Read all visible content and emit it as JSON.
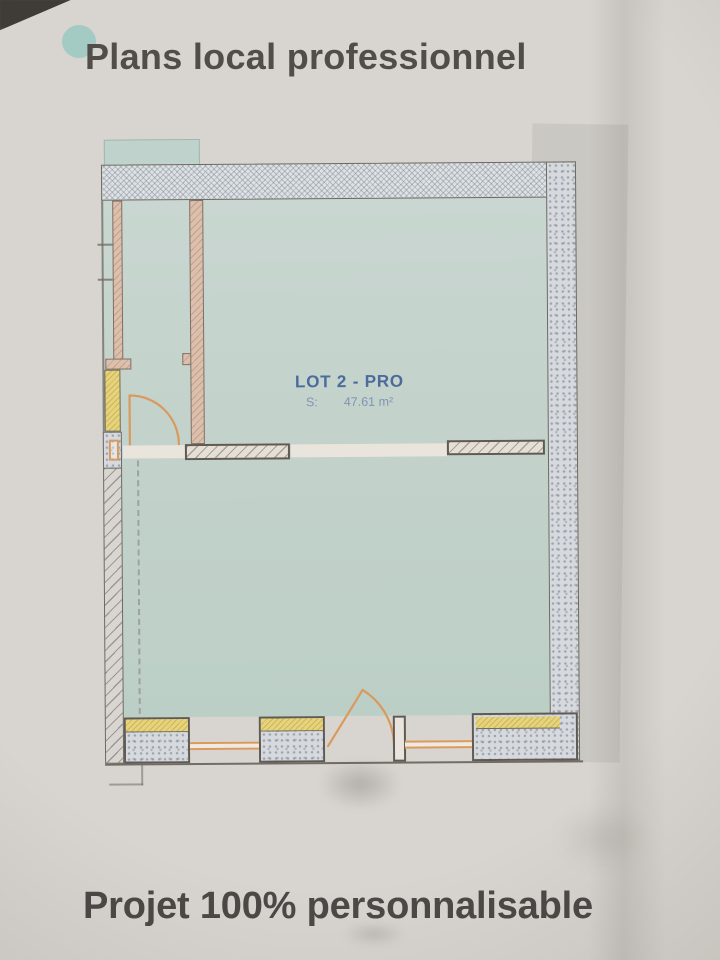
{
  "header": {
    "title": "Plans local professionnel"
  },
  "footer": {
    "title": "Projet 100% personnalisable"
  },
  "plan": {
    "room": {
      "name": "LOT 2 - PRO",
      "surface_label": "S:",
      "surface_value": "47.61 m²"
    }
  },
  "colors": {
    "accent_dot": "#a3cbc4",
    "label_blue": "#4a6b9c",
    "window_yellow": "#e7d47a",
    "door_orange": "#d99a5e",
    "room_fill": "#c3d2cb"
  }
}
